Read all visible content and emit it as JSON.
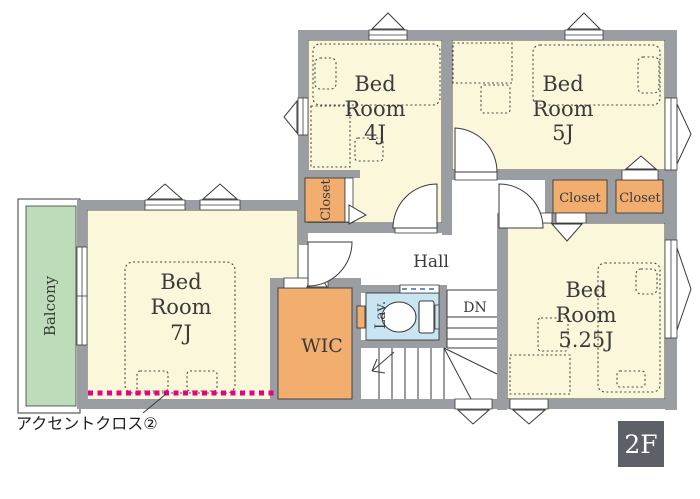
{
  "floor_badge": {
    "label": "2F"
  },
  "annotation": {
    "text": "アクセントクロス②"
  },
  "rooms": {
    "bedroom4": {
      "line1": "Bed",
      "line2": "Room",
      "line3": "4J"
    },
    "bedroom5": {
      "line1": "Bed",
      "line2": "Room",
      "line3": "5J"
    },
    "bedroom7": {
      "line1": "Bed",
      "line2": "Room",
      "line3": "7J"
    },
    "bedroom525": {
      "line1": "Bed",
      "line2": "Room",
      "line3": "5.25J"
    },
    "hall": {
      "label": "Hall"
    },
    "wic": {
      "label": "WIC"
    },
    "lav": {
      "label": "Lav."
    },
    "balcony": {
      "label": "Balcony"
    },
    "closet_4j": {
      "label": "Closet"
    },
    "closet_5j_left": {
      "label": "Closet"
    },
    "closet_5j_right": {
      "label": "Closet"
    },
    "stairs": {
      "down_label": "DN"
    }
  },
  "colors": {
    "room_fill": "#FBF7DB",
    "closet_fill": "#F2AE6E",
    "balcony_fill": "#BDDCB9",
    "lav_fill": "#C9E5F2",
    "wall_gray": "#9A9DA1",
    "accent_magenta": "#E4007F",
    "badge_gray": "#5D6167",
    "line_dark": "#3A3A3A"
  }
}
